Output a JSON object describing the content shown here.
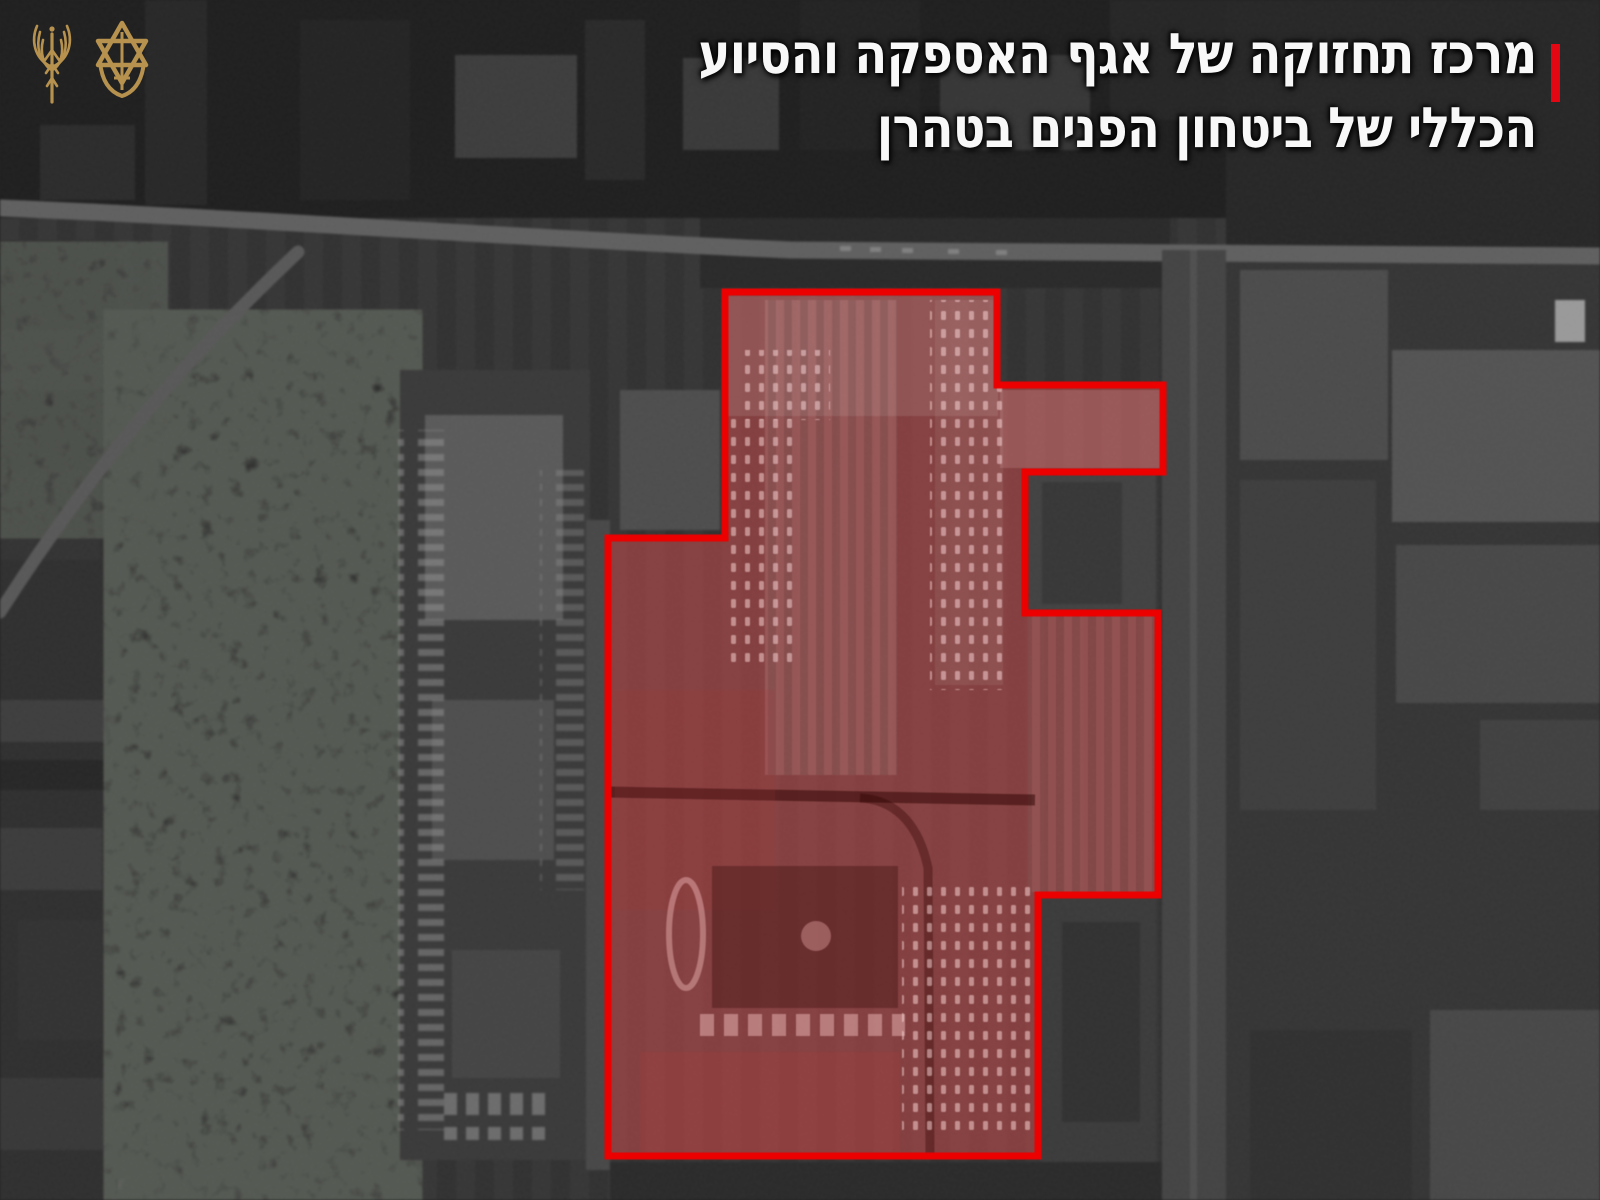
{
  "header": {
    "title_line1": "מרכז תחזוקה של אגף האספקה והסיוע",
    "title_line2": "הכללי של ביטחון הפנים בטהרן",
    "text_direction": "rtl"
  },
  "logos": {
    "left_icon": "winged-antenna-emblem",
    "right_icon": "idf-star-sword-emblem"
  },
  "colors": {
    "headline_text": "#f8f8f8",
    "accent_red": "#e30613",
    "annotation_stroke": "#ec0000",
    "annotation_fill": "#dd4f4f",
    "logo_gold": "#b6924e"
  },
  "map": {
    "imagery": "grayscale satellite view of industrial district",
    "annotation": "red outlined target compound"
  }
}
